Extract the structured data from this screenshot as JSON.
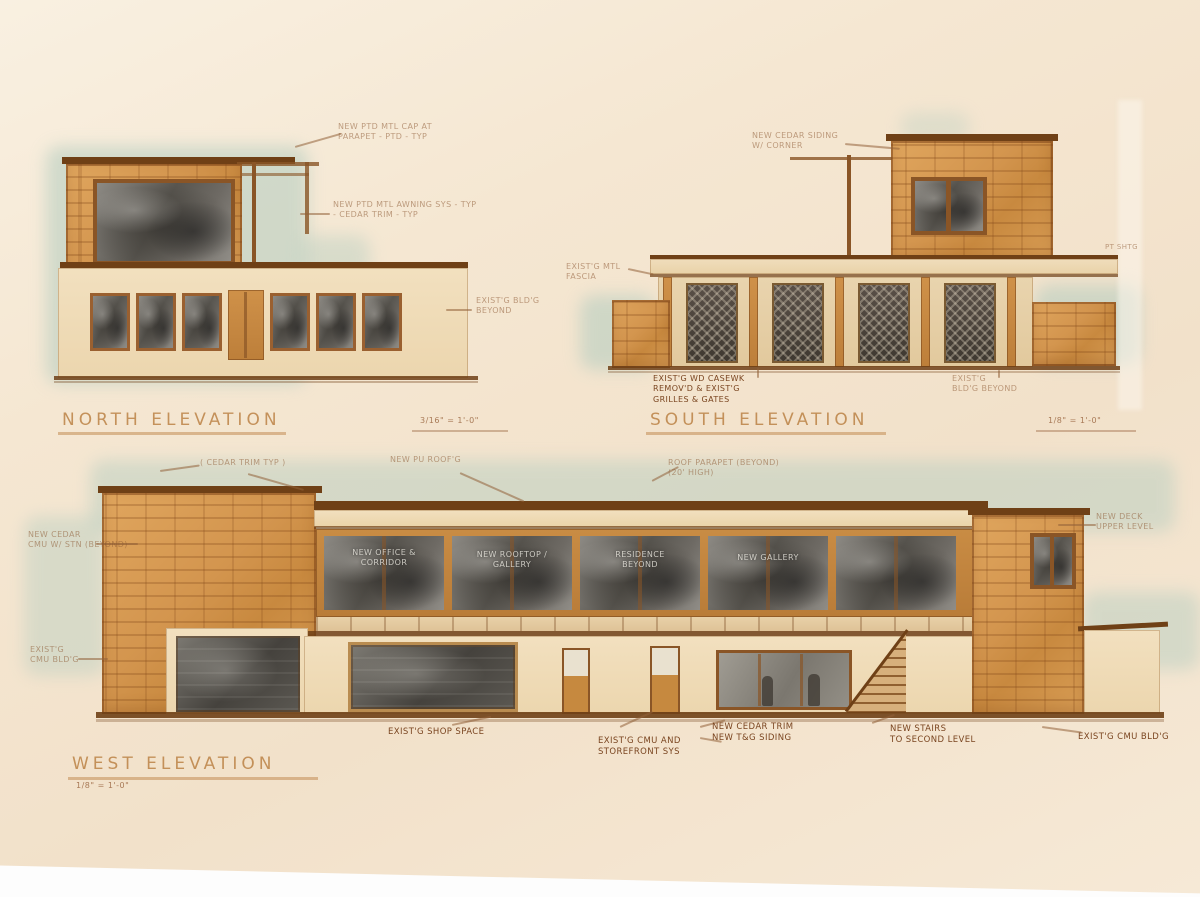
{
  "colors": {
    "paper": "#f4e7d3",
    "sky_wash": "#b7cec1",
    "stone": "#d5974f",
    "stone_line": "#8a5526",
    "cream_wall": "#f0dcba",
    "wood": "#c6893f",
    "dark_roof": "#6f4016",
    "glass_dark": "#55524e",
    "ink": "#8d5a34"
  },
  "elevations": {
    "north": {
      "title": "NORTH ELEVATION",
      "scale": "3/16\" = 1'-0\"",
      "annotations": [
        {
          "text": "NEW PTD MTL CAP AT\nPARAPET - PTD - TYP"
        },
        {
          "text": "NEW PTD MTL AWNING SYS - TYP\n- CEDAR TRIM - TYP"
        },
        {
          "text": "EXIST'G BLD'G\nBEYOND"
        }
      ]
    },
    "south": {
      "title": "SOUTH ELEVATION",
      "scale": "1/8\" = 1'-0\"",
      "annotations": [
        {
          "text": "NEW CEDAR SIDING\nW/ CORNER"
        },
        {
          "text": "EXIST'G MTL\nFASCIA"
        },
        {
          "text": "EXIST'G WD CASEWK\nREMOV'D & EXIST'G\nGRILLES & GATES"
        },
        {
          "text": "EXIST'G\nBLD'G BEYOND"
        },
        {
          "text": "PT SHTG"
        }
      ]
    },
    "west": {
      "title": "WEST ELEVATION",
      "scale": "1/8\" = 1'-0\"",
      "annotations": [
        {
          "text": "( CEDAR TRIM TYP )"
        },
        {
          "text": "NEW PU ROOF'G"
        },
        {
          "text": "ROOF PARAPET (BEYOND)\n(20' HIGH)"
        },
        {
          "text": "NEW DECK\nUPPER LEVEL"
        },
        {
          "text": "NEW CEDAR\nCMU W/ STN (BEYOND)"
        },
        {
          "text": "EXIST'G\nCMU BLD'G"
        },
        {
          "text": "EXIST'G SHOP SPACE"
        },
        {
          "text": "EXIST'G CMU AND\nSTOREFRONT SYS"
        },
        {
          "text": "NEW CEDAR TRIM\nNEW T&G SIDING"
        },
        {
          "text": "NEW STAIRS\nTO SECOND LEVEL"
        },
        {
          "text": "EXIST'G CMU BLD'G"
        }
      ],
      "window_labels": [
        {
          "text": "NEW OFFICE &\nCORRIDOR"
        },
        {
          "text": "NEW ROOFTOP /\nGALLERY"
        },
        {
          "text": "RESIDENCE\nBEYOND"
        },
        {
          "text": "NEW GALLERY"
        }
      ]
    }
  }
}
